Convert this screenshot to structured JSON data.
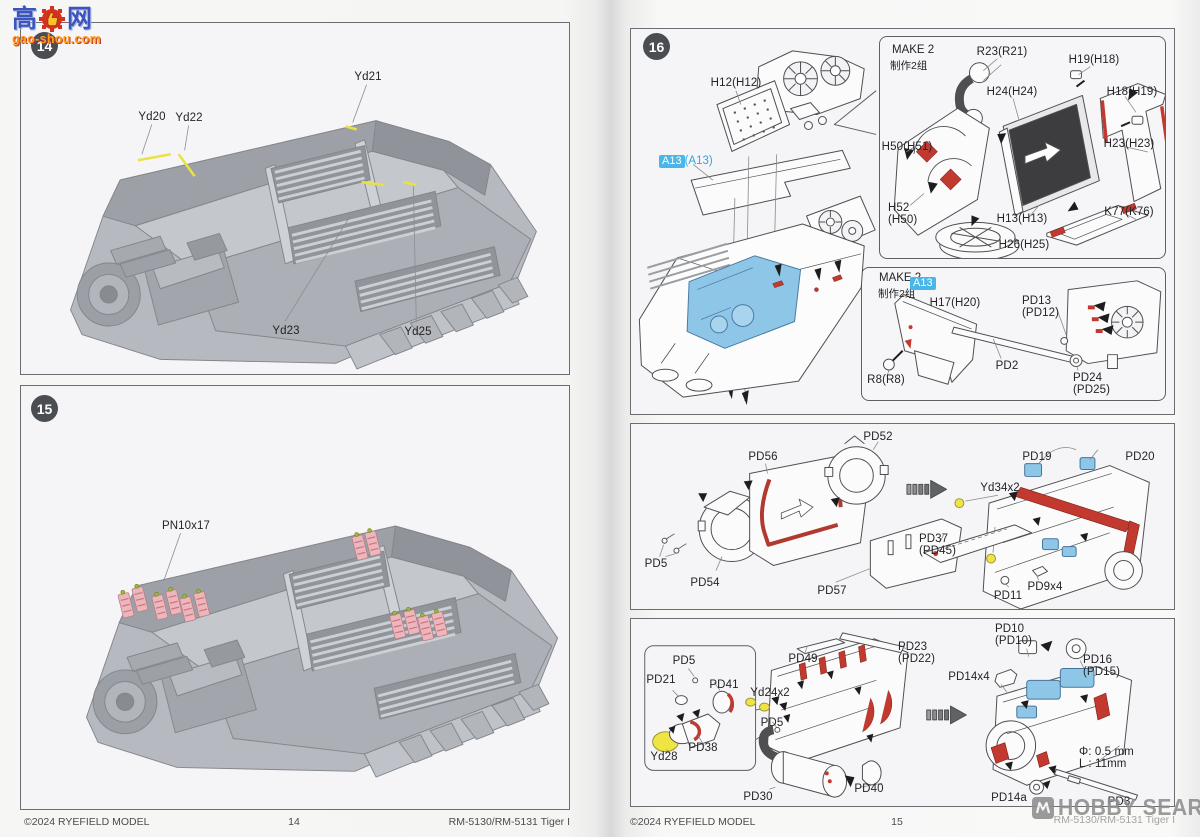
{
  "watermark_gaoshou": {
    "cn_left": "高",
    "cn_right": "网",
    "site": "gao-shou.com"
  },
  "watermark_hobby": {
    "text": "HOBBY SEARCH"
  },
  "footer_left": {
    "copyright": "©2024 RYEFIELD MODEL",
    "page_number": "14",
    "product_code": "RM-5130/RM-5131 Tiger I"
  },
  "footer_right": {
    "copyright": "©2024 RYEFIELD MODEL",
    "page_number": "15",
    "product_code": "RM-5130/RM-5131 Tiger I"
  },
  "step14": {
    "number": "14",
    "labels": {
      "yd20": "Yd20",
      "yd22": "Yd22",
      "yd21": "Yd21",
      "yd23": "Yd23",
      "yd25": "Yd25"
    }
  },
  "step15": {
    "number": "15",
    "labels": {
      "pn10x17": "PN10x17"
    }
  },
  "step16": {
    "number": "16",
    "main_labels": {
      "h12": "H12(H12)",
      "a13_badge": "A13",
      "a13_ref": "(A13)"
    },
    "make2_radiator": {
      "title": "MAKE 2",
      "subtitle": "制作2组",
      "labels": {
        "r23": "R23(R21)",
        "h19": "H19(H18)",
        "h18": "H18(H19)",
        "h24": "H24(H24)",
        "h50": "H50(H51)",
        "h23": "H23(H23)",
        "h52_line1": "H52",
        "h52_line2": "(H50)",
        "h13": "H13(H13)",
        "k77": "K77(K76)",
        "h26": "H26(H25)"
      }
    },
    "make2_firewall": {
      "title": "MAKE 2",
      "subtitle": "制作2组",
      "badge": "A13",
      "labels": {
        "h17": "H17(H20)",
        "r8": "R8(R8)",
        "pd13_line1": "PD13",
        "pd13_line2": "(PD12)",
        "pd2": "PD2",
        "pd24_line1": "PD24",
        "pd24_line2": "(PD25)"
      }
    },
    "engine_panel_a": {
      "labels": {
        "pd52": "PD52",
        "pd56": "PD56",
        "pd19": "PD19",
        "pd20": "PD20",
        "yd34": "Yd34x2",
        "pd37_line1": "PD37",
        "pd37_line2": "(PD45)",
        "pd5": "PD5",
        "pd54": "PD54",
        "pd57": "PD57",
        "pd9": "PD9x4",
        "pd11": "PD11"
      }
    },
    "engine_panel_b": {
      "labels": {
        "pd5_inset": "PD5",
        "pd21": "PD21",
        "pd41": "PD41",
        "pd38": "PD38",
        "yd28": "Yd28",
        "pd49": "PD49",
        "pd23_line1": "PD23",
        "pd23_line2": "(PD22)",
        "yd24": "Yd24x2",
        "pd5": "PD5",
        "pd30": "PD30",
        "pd40": "PD40",
        "pd10_line1": "PD10",
        "pd10_line2": "(PD10)",
        "pd16_line1": "PD16",
        "pd16_line2": "(PD15)",
        "pd14x4": "PD14x4",
        "drill_dia": "Φ: 0.5 mm",
        "drill_len": "L : 11mm",
        "pd14a": "PD14a",
        "pd3": "PD3"
      }
    }
  },
  "colors": {
    "highlight_red": "#c23a2f",
    "highlight_blue": "#8ec6e8",
    "highlight_yellow": "#e8e243",
    "badge_blue": "#49b6e9",
    "ammo_pink": "#ecb6bd"
  }
}
